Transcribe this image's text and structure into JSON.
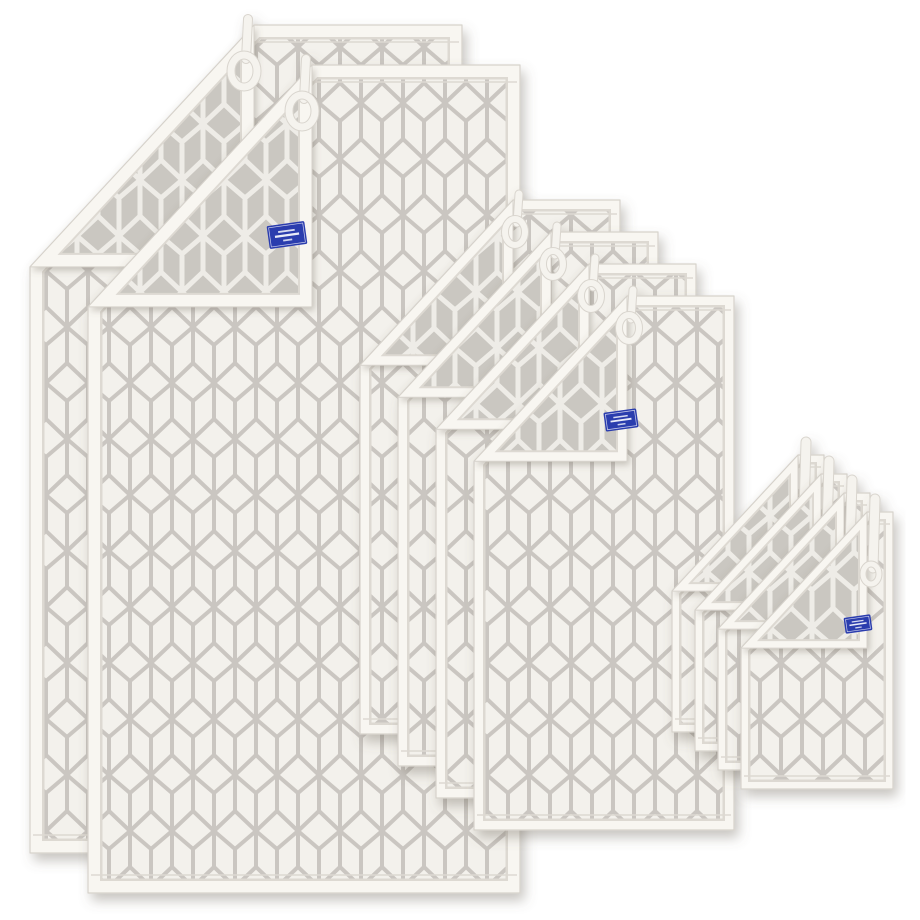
{
  "page": {
    "background": "#ffffff",
    "alt": "Ten-piece terry towel set with geometric cube pattern, white front with grey lines and grey reverse with white lines, folded corners, hanging loops and blue woven brand labels"
  },
  "towel_set": {
    "piece_count": 10,
    "pattern_name": "geometric-cube",
    "colors": {
      "front_bg": "#f3f1ec",
      "front_line": "#c8c4be",
      "reverse_bg": "#cac7c1",
      "reverse_line": "#f0eee9",
      "hem": "#f8f6f1",
      "hem_edge": "#ddd9d2",
      "outline": "#d6d2cb",
      "shadow": "#6e6758",
      "loop": "#f5f3ee",
      "loop_edge": "#d9d5ce",
      "label_bg": "#2c3cae",
      "label_border": "#ffffff",
      "label_text": "#e9ecf8"
    },
    "groups": [
      {
        "id": "bath-towels",
        "name": "bath towel",
        "count": 2
      },
      {
        "id": "hand-towels",
        "name": "hand towel",
        "count": 4
      },
      {
        "id": "guest-towels",
        "name": "guest towel",
        "count": 4
      }
    ],
    "label_lines": 3
  }
}
